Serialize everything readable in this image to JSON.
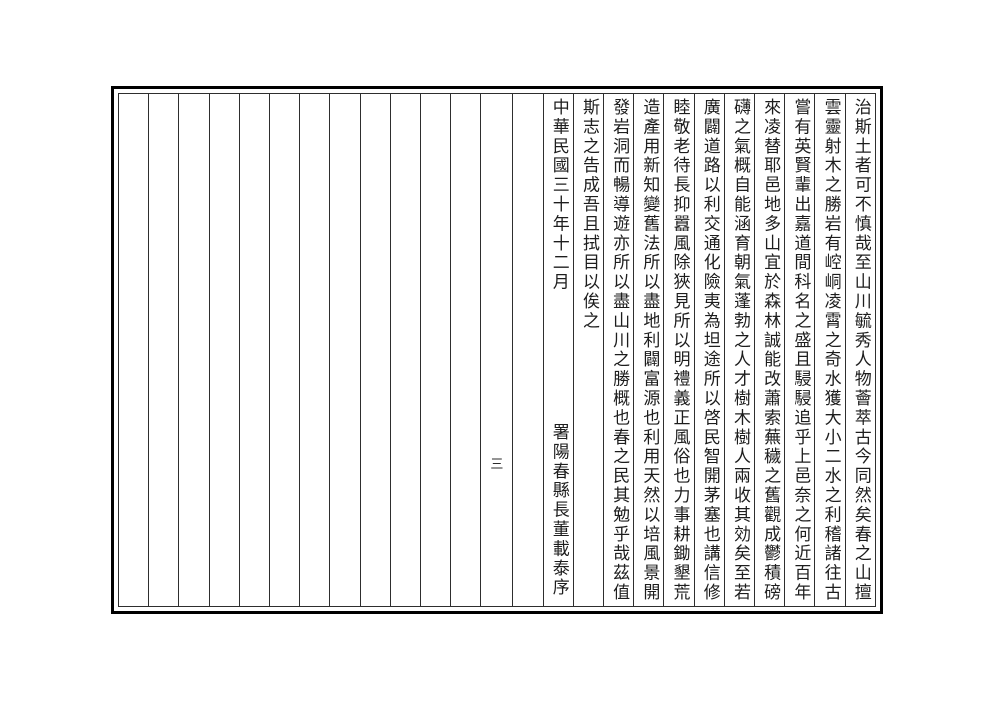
{
  "document": {
    "kind": "scanned gazetteer preface page, vertical classical Chinese, read right to left",
    "folio": {
      "page_number": "三"
    },
    "text_columns": [
      {
        "text": "治斯土者可不慎哉至山川毓秀人物薈萃古今同然矣春之山擅"
      },
      {
        "text": "雲靈射木之勝岩有崆峒凌霄之奇水獲大小二水之利稽諸往古"
      },
      {
        "text": "嘗有英賢輩出嘉道間科名之盛且駸駸追乎上邑奈之何近百年"
      },
      {
        "text": "來凌替耶邑地多山宜於森林誠能改蕭索蕪穢之舊觀成鬱積磅"
      },
      {
        "text": "礴之氣概自能涵育朝氣蓬勃之人才樹木樹人兩收其効矣至若"
      },
      {
        "text": "廣闢道路以利交通化險夷為坦途所以啓民智開茅塞也講信修"
      },
      {
        "text": "睦敬老待長抑囂風除狹見所以明禮義正風俗也力事耕鋤墾荒"
      },
      {
        "text": "造產用新知變舊法所以盡地利闢富源也利用天然以培風景開"
      },
      {
        "text": "發岩洞而暢導遊亦所以盡山川之勝概也春之民其勉乎哉茲值"
      },
      {
        "text": "斯志之告成吾且拭目以俟之"
      }
    ],
    "colophon": {
      "date": "中華民國三十年十二月",
      "signature": "署陽春縣長董載泰序"
    },
    "colors": {
      "paper": "#ffffff",
      "ink": "#1d1d1d",
      "rule_line": "#2e2e2e",
      "frame_border": "#000000"
    }
  }
}
